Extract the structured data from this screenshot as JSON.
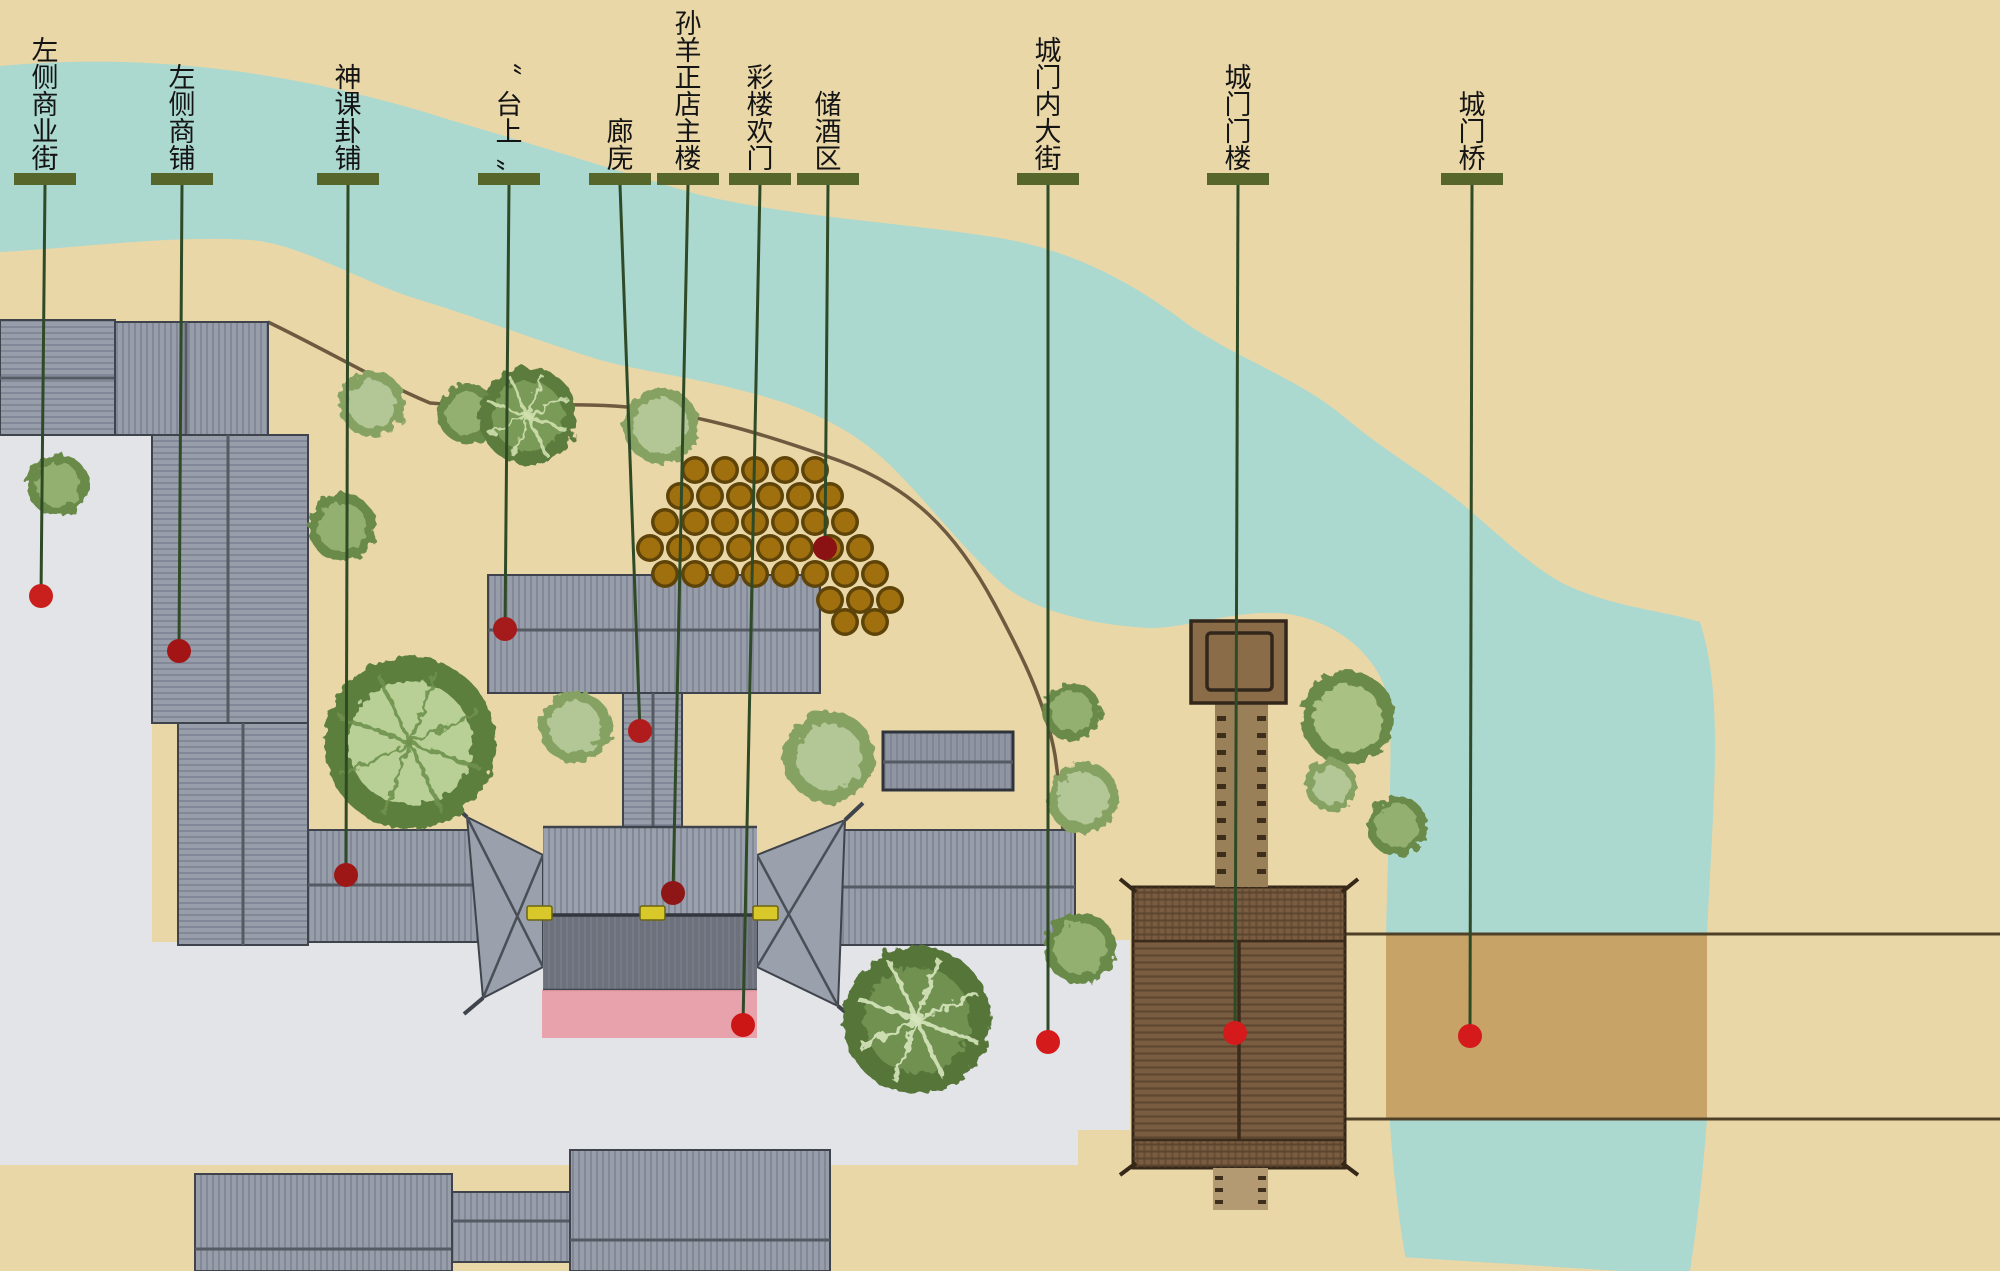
{
  "map": {
    "width": 2000,
    "height": 1271,
    "type": "annotated-site-plan",
    "colors": {
      "background": "#ead7a7",
      "river": "#abd8cf",
      "street": "#e3e4e8",
      "road_line": "#6e5a3e",
      "roof_base": "#979da9",
      "roof_base_dark": "#8f95a1",
      "roof_hatch": "#7e8494",
      "roof_border": "#3f444c",
      "ridge": "#565b63",
      "gatehouse_lower": "#6d717b",
      "gatehouse_valley": "#32363e",
      "gold_bar": "#d8c829",
      "gold_bar_border": "#6b6414",
      "carpet": "#e89aa4",
      "gate_brown": "#7a5d40",
      "gate_brown_line": "#55402c",
      "gate_border": "#352818",
      "walkway": "#9a8058",
      "walkway_dash": "#3d2e1c",
      "stub": "#b49a72",
      "pavilion": "#8a6c48",
      "pavilion_border": "#33261a",
      "bridge_band": "#c7a367",
      "bridge_line": "#4f4028",
      "label_bar": "#57672c",
      "leader": "#2f4a26",
      "label_text": "#141414",
      "jar_outer": "#5e4409",
      "jar_inner": "#a0700f"
    },
    "legend_note": "",
    "labels": [
      {
        "id": "left-commercial-street",
        "text": "左侧商业街",
        "bar_x": 45,
        "dot": [
          41,
          596
        ],
        "dot_color": "#c9201d"
      },
      {
        "id": "left-shops",
        "text": "左侧商铺",
        "bar_x": 182,
        "dot": [
          179,
          651
        ],
        "dot_color": "#a31515"
      },
      {
        "id": "divination-shop",
        "text": "神课卦铺",
        "bar_x": 348,
        "dot": [
          346,
          875
        ],
        "dot_color": "#9e1717"
      },
      {
        "id": "on-stage",
        "text": "〝台上〟",
        "bar_x": 509,
        "dot": [
          505,
          629
        ],
        "dot_color": "#a51a1a"
      },
      {
        "id": "corridor-langwu",
        "text": "廊庑",
        "bar_x": 620,
        "dot": [
          640,
          731
        ],
        "dot_color": "#b01c1c"
      },
      {
        "id": "sunyang-main-building",
        "text": "孙羊正店主楼",
        "bar_x": 688,
        "dot": [
          673,
          893
        ],
        "dot_color": "#8f1616"
      },
      {
        "id": "cailou-huanmen",
        "text": "彩楼欢门",
        "bar_x": 760,
        "dot": [
          743,
          1025
        ],
        "dot_color": "#cc1616"
      },
      {
        "id": "wine-storage-area",
        "text": "储酒区",
        "bar_x": 828,
        "dot": [
          825,
          548
        ],
        "dot_color": "#8b1212"
      },
      {
        "id": "gate-inner-street",
        "text": "城门内大街",
        "bar_x": 1048,
        "dot": [
          1048,
          1042
        ],
        "dot_color": "#d41a1a"
      },
      {
        "id": "gate-tower",
        "text": "城门门楼",
        "bar_x": 1238,
        "dot": [
          1235,
          1033
        ],
        "dot_color": "#d41a1a"
      },
      {
        "id": "gate-bridge",
        "text": "城门桥",
        "bar_x": 1472,
        "dot": [
          1470,
          1036
        ],
        "dot_color": "#d41a1a"
      }
    ],
    "label_style": {
      "bar_w": 62,
      "bar_h": 12,
      "bar_y": 173,
      "char_size": 27,
      "dot_r": 12
    },
    "buildings": [
      {
        "id": "shop-row-nw-a",
        "x": 0,
        "y": 320,
        "w": 115,
        "h": 115,
        "hatch": "h",
        "ridge": "h",
        "rp": 378
      },
      {
        "id": "shop-row-nw-b",
        "x": 115,
        "y": 322,
        "w": 153,
        "h": 113,
        "hatch": "v",
        "ridge": "v",
        "rp": 186
      },
      {
        "id": "west-shops-upper",
        "x": 152,
        "y": 435,
        "w": 156,
        "h": 288,
        "hatch": "h",
        "ridge": "v",
        "rp": 228
      },
      {
        "id": "west-shops-lower",
        "x": 178,
        "y": 723,
        "w": 130,
        "h": 222,
        "hatch": "h",
        "ridge": "v",
        "rp": 243
      },
      {
        "id": "divination-shop-row",
        "x": 308,
        "y": 830,
        "w": 182,
        "h": 112,
        "hatch": "v",
        "ridge": "h",
        "rp": 885
      },
      {
        "id": "east-wing-row",
        "x": 820,
        "y": 830,
        "w": 255,
        "h": 115,
        "hatch": "v",
        "ridge": "h",
        "rp": 887
      },
      {
        "id": "small-outbuilding",
        "x": 883,
        "y": 732,
        "w": 130,
        "h": 58,
        "hatch": "v",
        "ridge": "h",
        "rp": 762,
        "dark": true
      },
      {
        "id": "stage-main-building",
        "x": 488,
        "y": 575,
        "w": 332,
        "h": 118,
        "hatch": "v",
        "ridge": "h",
        "rp": 630
      },
      {
        "id": "corridor-wing",
        "x": 623,
        "y": 693,
        "w": 59,
        "h": 134,
        "hatch": "h",
        "ridge": "v",
        "rp": 653
      },
      {
        "id": "south-block-west",
        "x": 195,
        "y": 1174,
        "w": 257,
        "h": 97,
        "hatch": "v",
        "ridge": "h",
        "rp": 1249
      },
      {
        "id": "south-connector",
        "x": 452,
        "y": 1192,
        "w": 123,
        "h": 70,
        "hatch": "v",
        "ridge": "h",
        "rp": 1221
      },
      {
        "id": "south-block-center",
        "x": 570,
        "y": 1150,
        "w": 260,
        "h": 121,
        "hatch": "v",
        "ridge": "h",
        "rp": 1240
      }
    ],
    "trees": [
      {
        "x": 372,
        "y": 404,
        "r": 33,
        "t": "light"
      },
      {
        "x": 468,
        "y": 414,
        "r": 30,
        "t": "med"
      },
      {
        "x": 528,
        "y": 416,
        "r": 49,
        "t": "darkrad"
      },
      {
        "x": 661,
        "y": 426,
        "r": 38,
        "t": "light"
      },
      {
        "x": 58,
        "y": 485,
        "r": 31,
        "t": "med"
      },
      {
        "x": 342,
        "y": 527,
        "r": 34,
        "t": "med"
      },
      {
        "x": 410,
        "y": 743,
        "r": 86,
        "t": "bigrad"
      },
      {
        "x": 575,
        "y": 727,
        "r": 36,
        "t": "light"
      },
      {
        "x": 829,
        "y": 757,
        "r": 46,
        "t": "light"
      },
      {
        "x": 917,
        "y": 1020,
        "r": 74,
        "t": "darkrad2"
      },
      {
        "x": 1072,
        "y": 712,
        "r": 29,
        "t": "med"
      },
      {
        "x": 1083,
        "y": 798,
        "r": 36,
        "t": "light"
      },
      {
        "x": 1080,
        "y": 948,
        "r": 36,
        "t": "med"
      },
      {
        "x": 1348,
        "y": 718,
        "r": 47,
        "t": "medlight"
      },
      {
        "x": 1331,
        "y": 785,
        "r": 26,
        "t": "light"
      },
      {
        "x": 1397,
        "y": 826,
        "r": 30,
        "t": "med"
      }
    ],
    "jars": {
      "r": 14,
      "rows": [
        {
          "y": 470,
          "xs": [
            695,
            725,
            755,
            785,
            815
          ]
        },
        {
          "y": 496,
          "xs": [
            680,
            710,
            740,
            770,
            800,
            830
          ]
        },
        {
          "y": 522,
          "xs": [
            665,
            695,
            725,
            755,
            785,
            815,
            845
          ]
        },
        {
          "y": 548,
          "xs": [
            650,
            680,
            710,
            740,
            770,
            800,
            830,
            860
          ]
        },
        {
          "y": 574,
          "xs": [
            665,
            695,
            725,
            755,
            785,
            815,
            845,
            875
          ]
        },
        {
          "y": 600,
          "xs": [
            830,
            860,
            890
          ]
        },
        {
          "y": 622,
          "xs": [
            845,
            875
          ]
        }
      ]
    },
    "gold_bars": [
      [
        527,
        906
      ],
      [
        640,
        906
      ],
      [
        753,
        906
      ]
    ]
  }
}
